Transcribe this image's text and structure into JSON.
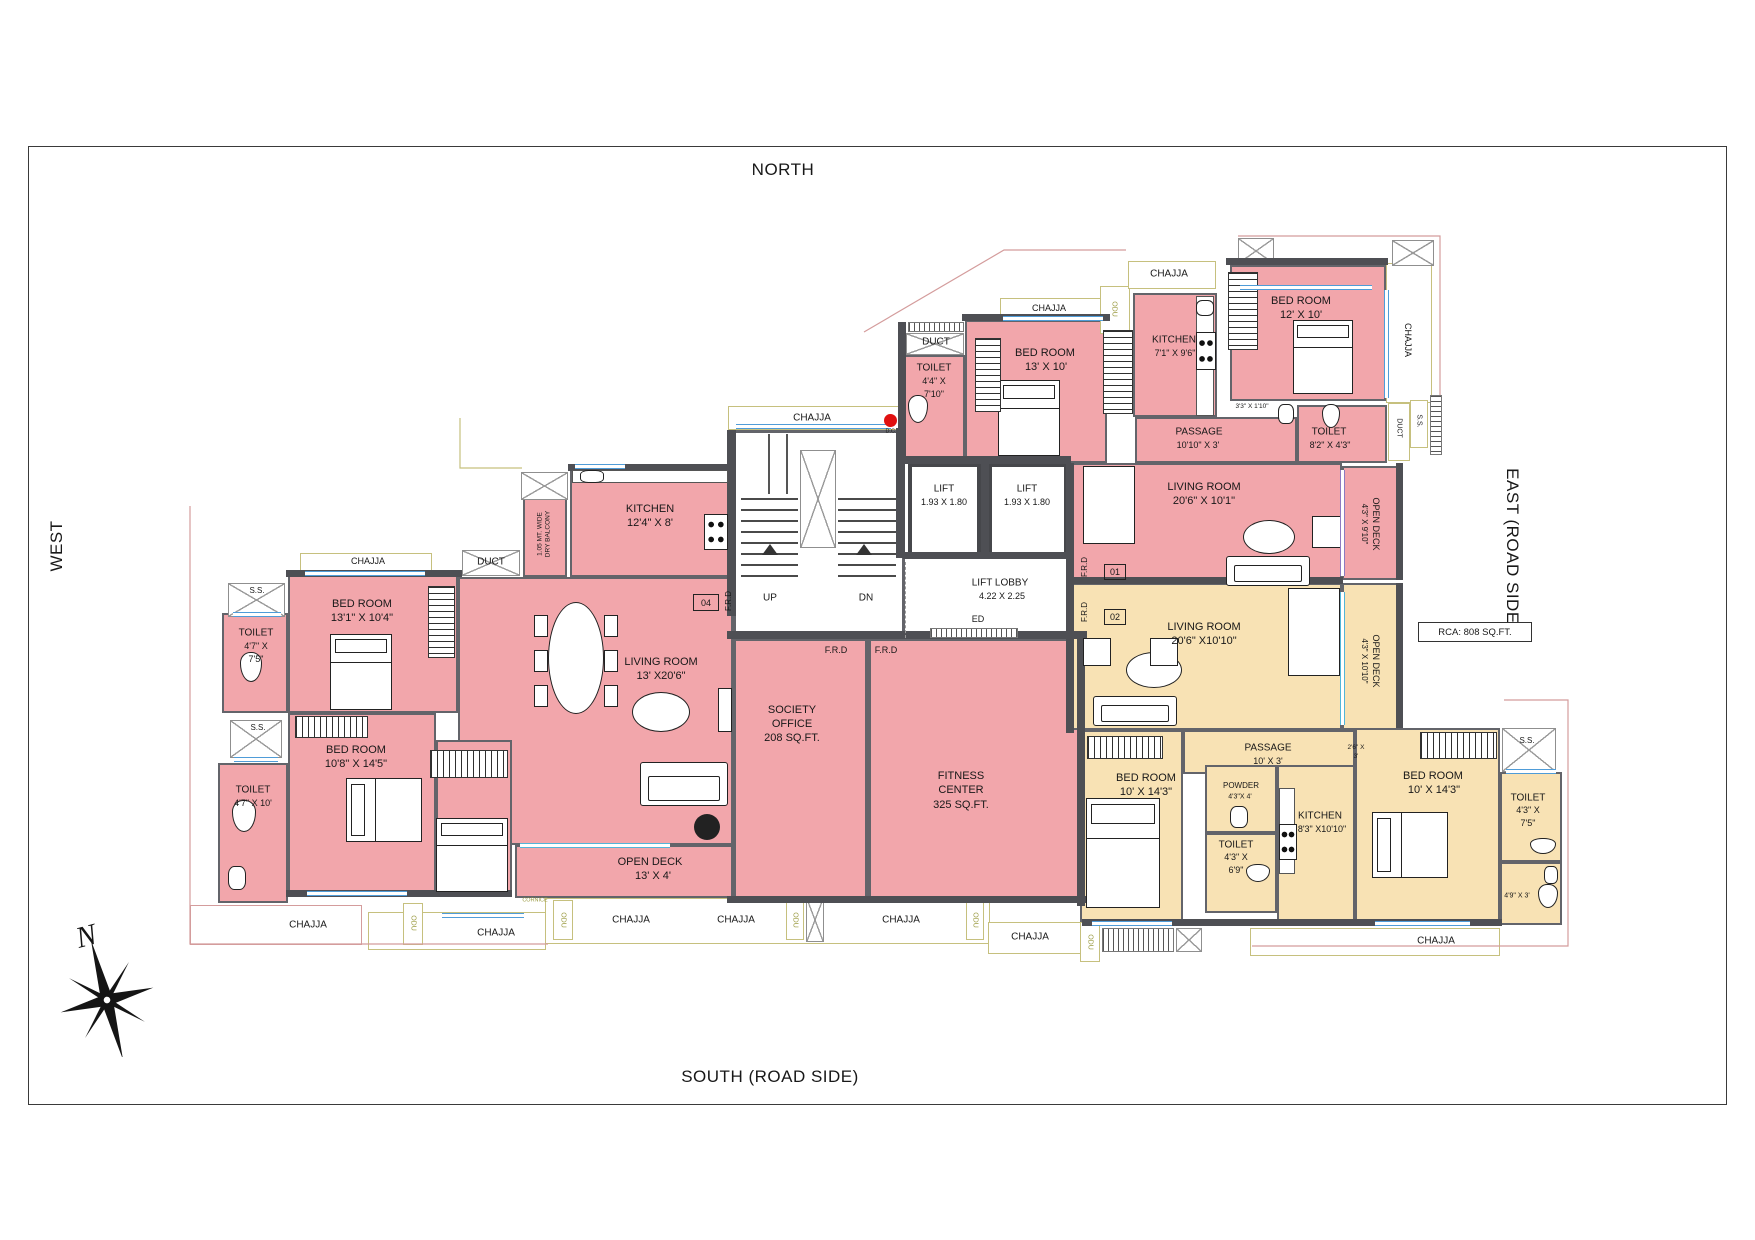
{
  "sheet": {
    "north": "NORTH",
    "south": "SOUTH (ROAD SIDE)",
    "west": "WEST",
    "east": "EAST (ROAD SIDE)",
    "compass_n": "N",
    "rca_note": "RCA: 808 SQ.FT."
  },
  "labels": {
    "chajja": "CHAJJA",
    "odu": "ODU",
    "ss": "S.S.",
    "duct": "DUCT",
    "frd": "F.R.D",
    "up": "UP",
    "dn": "DN",
    "ed": "ED",
    "dc": "D.C.",
    "cornice": "CORNICE",
    "unit01": "01",
    "unit02": "02",
    "unit04": "04",
    "dry_balcony_l1": "1.05 MT. WIDE",
    "dry_balcony_l2": "DRY BALCONY"
  },
  "rooms": {
    "bed1": {
      "name": "BED ROOM",
      "dims": "13'1\" X 10'4\""
    },
    "toilet1": {
      "name": "TOILET",
      "d1": "4'7\" X",
      "d2": "7'5\""
    },
    "bed2": {
      "name": "BED ROOM",
      "dims": "10'8\" X 14'5\""
    },
    "toilet2": {
      "name": "TOILET",
      "dims": "4'7\" X 10'"
    },
    "kitchen04": {
      "name": "KITCHEN",
      "dims": "12'4\" X 8'"
    },
    "living04": {
      "name": "LIVING ROOM",
      "dims": "13' X20'6\""
    },
    "deck04": {
      "name": "OPEN DECK",
      "dims": "13' X 4'"
    },
    "society": {
      "l1": "SOCIETY",
      "l2": "OFFICE",
      "l3": "208  SQ.FT."
    },
    "fitness": {
      "l1": "FITNESS",
      "l2": "CENTER",
      "l3": "325  SQ.FT."
    },
    "lift1": {
      "name": "LIFT",
      "dims": "1.93 X 1.80"
    },
    "lift2": {
      "name": "LIFT",
      "dims": "1.93 X 1.80"
    },
    "lobby": {
      "name": "LIFT LOBBY",
      "dims": "4.22 X 2.25"
    },
    "toilet3": {
      "name": "TOILET",
      "d1": "4'4\" X",
      "d2": "7'10\""
    },
    "bed3": {
      "name": "BED ROOM",
      "dims": "13' X 10'"
    },
    "kitchen01": {
      "name": "KITCHEN",
      "dims": "7'1\" X 9'6\""
    },
    "bed4": {
      "name": "BED ROOM",
      "dims": "12' X 10'"
    },
    "passage01": {
      "name": "PASSAGE",
      "dims": "10'10\" X 3'"
    },
    "toilet4": {
      "name": "TOILET",
      "dims": "8'2\" X 4'3\""
    },
    "living01": {
      "name": "LIVING ROOM",
      "dims": "20'6\" X 10'1\""
    },
    "deck01": {
      "name": "OPEN DECK",
      "dims": "4'3\" X 9'10\""
    },
    "living02": {
      "name": "LIVING ROOM",
      "dims": "20'6\" X10'10\""
    },
    "deck02": {
      "name": "OPEN DECK",
      "dims": "4'3\" X 10'10\""
    },
    "passage02": {
      "name": "PASSAGE",
      "dims": "10' X 3'"
    },
    "bed5": {
      "name": "BED ROOM",
      "dims": "10' X 14'3\""
    },
    "powder": {
      "name": "POWDER",
      "dims": "4'3\"X 4'"
    },
    "toilet5": {
      "name": "TOILET",
      "d1": "4'3\" X",
      "d2": "6'9\""
    },
    "kitchen02": {
      "name": "KITCHEN",
      "dims": "8'3\" X10'10\""
    },
    "bed6": {
      "name": "BED ROOM",
      "dims": "10' X 14'3\""
    },
    "toilet6": {
      "name": "TOILET",
      "d1": "4'3\" X",
      "d2": "7'5\""
    },
    "small_a": "3'3\" X 1'10\"",
    "small_b1": "2'6\" X",
    "small_b2": "3'",
    "small_c": "4'9\" X 3'"
  }
}
